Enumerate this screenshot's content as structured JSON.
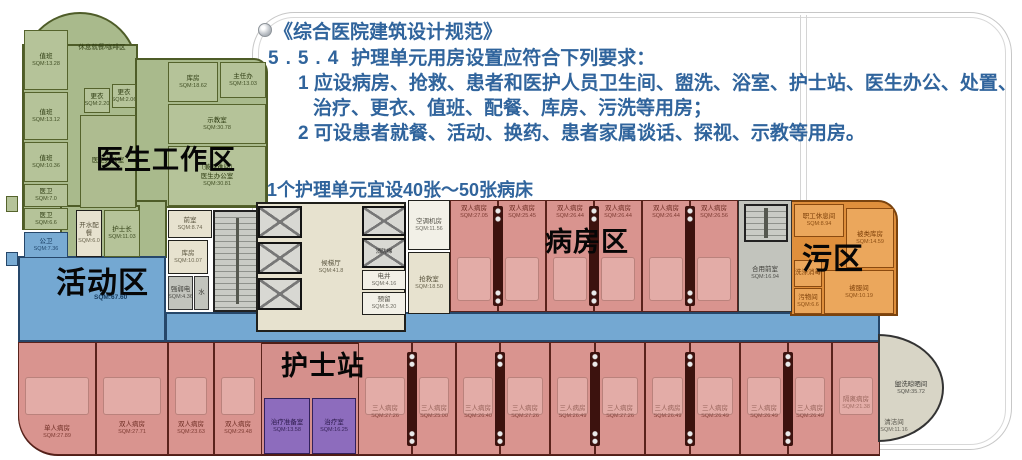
{
  "regulation": {
    "title": "《综合医院建筑设计规范》",
    "clause_no": "5.5.4",
    "clause": "护理单元用房设置应符合下列要求：",
    "item1a": "1 应设病房、抢救、患者和医护人员卫生间、盥洗、浴室、护士站、医生办公、处置、",
    "item1b": "治疗、更衣、值班、配餐、库房、污洗等用房；",
    "item2": "2 可设患者就餐、活动、换药、患者家属谈话、探视、示教等用房。",
    "beds_note": "1个护理单元宜设40张～50张病床"
  },
  "zones": {
    "doctor": {
      "label": "医生工作区"
    },
    "activity": {
      "label": "活动区",
      "sqm": "SQM:67.60"
    },
    "ward": {
      "label": "病房区"
    },
    "dirty": {
      "label": "污区"
    },
    "nurse": {
      "label": "护士站"
    }
  },
  "doctor_rooms": [
    {
      "name": "值班",
      "sqm": "SQM:13.28"
    },
    {
      "name": "休息就餐/咖啡区",
      "sqm": ""
    },
    {
      "name": "值班",
      "sqm": "SQM:13.12"
    },
    {
      "name": "值班",
      "sqm": "SQM:10.36"
    },
    {
      "name": "医卫",
      "sqm": "SQM:7.0"
    },
    {
      "name": "医卫",
      "sqm": "SQM:6.6"
    },
    {
      "name": "更衣",
      "sqm": "SQM:2.20"
    },
    {
      "name": "更衣",
      "sqm": "SQM:2.06"
    },
    {
      "name": "医生办公室",
      "sqm": ""
    },
    {
      "name": "库房",
      "sqm": "SQM:18.62"
    },
    {
      "name": "主任办",
      "sqm": "SQM:13.03"
    },
    {
      "name": "示教室",
      "sqm": "SQM:30.78"
    },
    {
      "name": "（兼避难间）\n医生办公室",
      "sqm": "SQM:30.81"
    },
    {
      "name": "开水配餐",
      "sqm": "SQM:6.0"
    },
    {
      "name": "护士长",
      "sqm": "SQM:11.03"
    }
  ],
  "core_rooms": [
    {
      "name": "前室",
      "sqm": "SQM:8.74"
    },
    {
      "name": "库房",
      "sqm": "SQM:10.07"
    },
    {
      "name": "强弱电",
      "sqm": "SQM:4.36"
    },
    {
      "name": "水",
      "sqm": ""
    },
    {
      "name": "候梯厅",
      "sqm": "SQM:41.8"
    },
    {
      "name": "消防梯",
      "sqm": ""
    },
    {
      "name": "电井",
      "sqm": "SQM:4.16"
    },
    {
      "name": "预留",
      "sqm": "SQM:5.20"
    },
    {
      "name": "空调机房",
      "sqm": "SQM:11.56"
    },
    {
      "name": "抢救室",
      "sqm": "SQM:18.50"
    },
    {
      "name": "合用前室",
      "sqm": "SQM:16.94"
    },
    {
      "name": "盥洗晾晒间",
      "sqm": "SQM:35.72"
    },
    {
      "name": "清洁间",
      "sqm": "SQM:11.16"
    }
  ],
  "activity_rooms": [
    {
      "name": "公卫",
      "sqm": "SQM:7.36"
    }
  ],
  "nurse_rooms": [
    {
      "name": "治疗准备室",
      "sqm": "SQM:13.58"
    },
    {
      "name": "治疗室",
      "sqm": "SQM:16.25"
    }
  ],
  "dirty_rooms": [
    {
      "name": "职工休息间",
      "sqm": "SQM:8.94"
    },
    {
      "name": "被类库房",
      "sqm": "SQM:14.59"
    },
    {
      "name": "洗涤消毒",
      "sqm": ""
    },
    {
      "name": "污物间",
      "sqm": "SQM:6.6"
    },
    {
      "name": "被服间",
      "sqm": "SQM:10.19"
    }
  ],
  "ward_top": [
    {
      "name": "双人病房",
      "sqm": "SQM:27.05"
    },
    {
      "name": "双人病房",
      "sqm": "SQM:25.45"
    },
    {
      "name": "双人病房",
      "sqm": "SQM:26.44"
    },
    {
      "name": "双人病房",
      "sqm": "SQM:26.44"
    },
    {
      "name": "双人病房",
      "sqm": "SQM:26.44"
    },
    {
      "name": "双人病房",
      "sqm": "SQM:26.56"
    }
  ],
  "ward_bottom": [
    {
      "name": "单人病房",
      "sqm": "SQM:27.89"
    },
    {
      "name": "双人病房",
      "sqm": "SQM:27.71"
    },
    {
      "name": "双人病房",
      "sqm": "SQM:23.63"
    },
    {
      "name": "双人病房",
      "sqm": "SQM:29.48"
    },
    {
      "name": "三人病房",
      "sqm": "SQM:27.26"
    },
    {
      "name": "三人病房",
      "sqm": "SQM:25.00"
    },
    {
      "name": "三人病房",
      "sqm": "SQM:26.40"
    },
    {
      "name": "三人病房",
      "sqm": "SQM:27.26"
    },
    {
      "name": "三人病房",
      "sqm": "SQM:26.49"
    },
    {
      "name": "三人病房",
      "sqm": "SQM:27.26"
    },
    {
      "name": "三人病房",
      "sqm": "SQM:26.49"
    },
    {
      "name": "三人病房",
      "sqm": "SQM:26.49"
    },
    {
      "name": "三人病房",
      "sqm": "SQM:26.49"
    },
    {
      "name": "三人病房",
      "sqm": "SQM:26.49"
    },
    {
      "name": "隔离病房",
      "sqm": "SQM:21.38"
    }
  ]
}
